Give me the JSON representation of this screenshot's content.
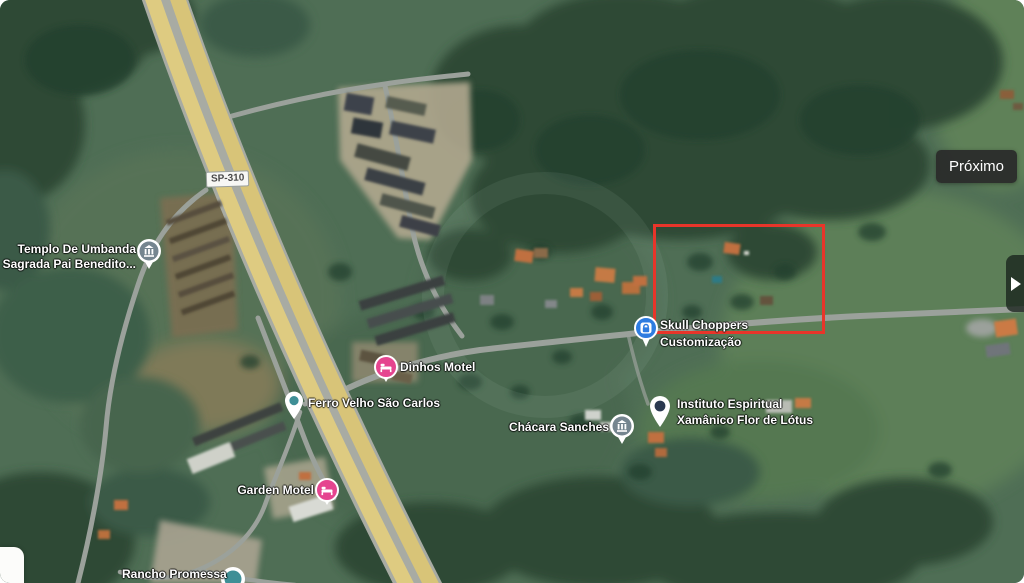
{
  "carousel": {
    "next_button_label": "Próximo",
    "edge_arrow_icon": "chevron-right"
  },
  "map": {
    "type": "satellite-imagery",
    "road_badge": "SP-310",
    "highlight_color": "#e8352a",
    "labels": {
      "templo": {
        "line1": "Templo De Umbanda",
        "line2": "Sagrada Pai Benedito...",
        "icon": "temple-icon"
      },
      "dinhos": {
        "text": "Dinhos Motel",
        "icon": "bed-icon",
        "icon_color": "#e5458f"
      },
      "ferro": {
        "text": "Ferro Velho São Carlos",
        "icon": "pin-icon"
      },
      "garden": {
        "text": "Garden Motel",
        "icon": "bed-icon",
        "icon_color": "#e5458f"
      },
      "rancho": {
        "text": "Rancho Promessa",
        "icon": "circle-marker-icon"
      },
      "skull": {
        "line1": "Skull Choppers",
        "line2": "Customização",
        "icon": "lock-shop-icon",
        "icon_color": "#2e7ce0"
      },
      "chacara": {
        "text": "Chácara Sanches",
        "icon": "temple-icon"
      },
      "instituto": {
        "line1": "Instituto Espiritual",
        "line2": "Xamânico Flor de Lótus",
        "icon": "pin-icon"
      }
    }
  }
}
